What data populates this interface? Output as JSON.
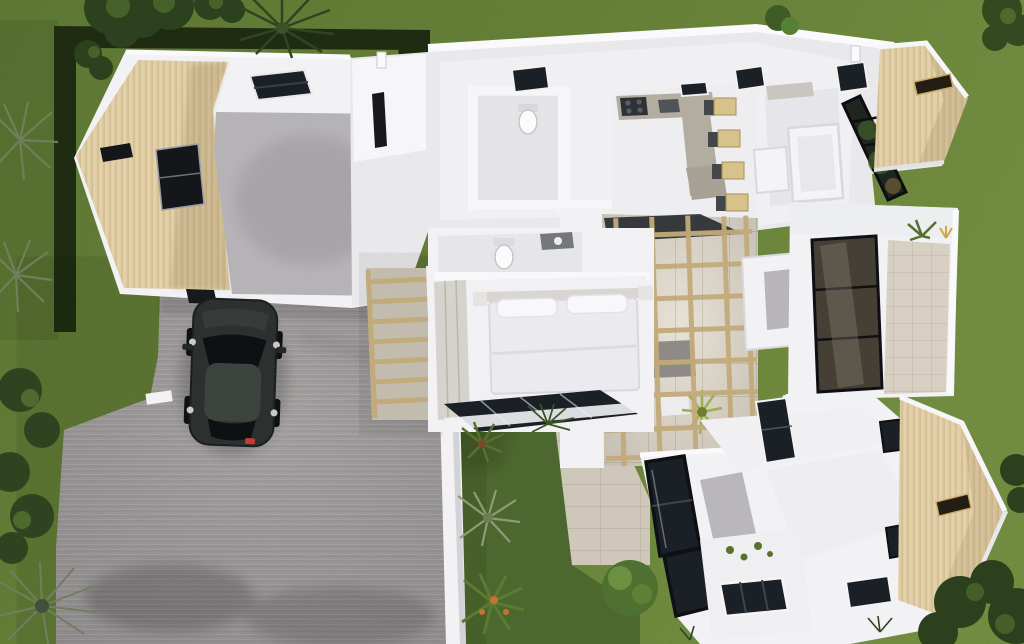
{
  "scene": {
    "title": "Top-down 3D architectural render",
    "description": "Aerial dollhouse view of a modern single-storey home with the roof cut away: timber-clad garage top-left, grey paver driveway with a dark parked car, white-walled interior rooms (kitchen with island and bar stools, living room with white sofa, bedroom with double bed, two bathrooms), a central courtyard atrium with timber pergola beams, a glazed terrace wing on the right, two timber-clad gable wings pointing right, lawns, hedges, palms and shrubs around the plot.",
    "objects": [
      "garage",
      "driveway",
      "parked-car",
      "main-house",
      "kitchen",
      "living-room",
      "bedroom",
      "bathroom",
      "wc",
      "atrium-courtyard",
      "pergola-walkway",
      "right-terrace",
      "bottom-wing",
      "timber-gable-top-right",
      "timber-gable-bottom-right",
      "hedges",
      "palm-trees",
      "shrubs",
      "inner-garden",
      "stone-path",
      "skylights",
      "glass-walls"
    ]
  },
  "colors": {
    "grass_light": "#7d9a47",
    "grass_mid": "#67843a",
    "grass_dark": "#4d682e",
    "hedge": "#1f2c12",
    "tree_dark": "#2c411d",
    "tree_mid": "#4e6a2e",
    "palm_gray": "#6f7f5c",
    "driveway": "#a5a1a2",
    "wall_white": "#f2f2f5",
    "wall_light": "#fafafc",
    "wall_mid": "#e9e9ec",
    "wall_shade": "#d8d8de",
    "timber": "#e0cda4",
    "beam": "#c2ab7a",
    "glass_dark": "#1b2026",
    "glass_brown": "#463f35",
    "frame_black": "#0e1013",
    "garage_floor": "#b6b3b6",
    "concrete_floor": "#c5bfb4",
    "travertine": "#d8d1c3",
    "stone_path": "#cfc8ba",
    "counter": "#b2aca1",
    "cooktop": "#2e3236",
    "stool_wood": "#d8c28c",
    "furniture_white": "#f4f3f6",
    "bed_duvet": "#ebebef",
    "bed_pillow": "#f8f8fa",
    "wardrobe": "#d6d3cd",
    "table_gray": "#8e8b86",
    "window_gray": "#b8b6ba",
    "vent_gray": "#c9c6bf",
    "car_body": "#2c302e",
    "car_roof": "#3d433f",
    "car_glass": "#0e1114",
    "car_red": "#c23b2e",
    "plant_green": "#57722d",
    "plant_yellow": "#9db04c",
    "plant_orange": "#c7732f",
    "slot_frame_gold": "#c9a96a"
  }
}
